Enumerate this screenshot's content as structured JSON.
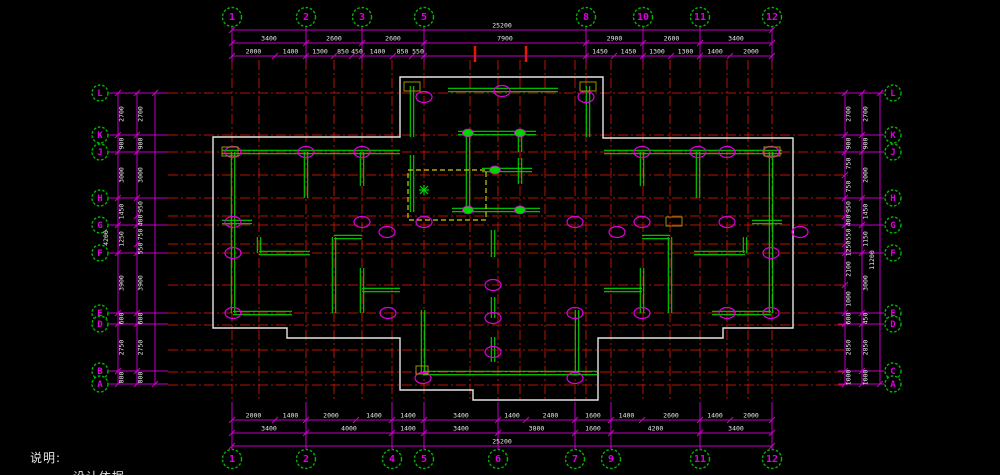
{
  "note": {
    "title": "说明:",
    "line2": "一.设计依据"
  },
  "colors": {
    "background": "#000000",
    "dim_magenta": "#c400c4",
    "bubble_ring_green": "#00b400",
    "bubble_text_magenta": "#dd00dd",
    "grid_red": "#b71400",
    "bright_red": "#e81800",
    "wall_green": "#00d400",
    "outline_white": "#e6e6e6",
    "dim_text_white": "#e8e8e8",
    "aux_yellow": "#cfcf00",
    "olive": "#9d8f00"
  },
  "axes": {
    "top": {
      "y": 17,
      "items": [
        {
          "label": "1",
          "x": 232
        },
        {
          "label": "2",
          "x": 306
        },
        {
          "label": "3",
          "x": 362
        },
        {
          "label": "5",
          "x": 424
        },
        {
          "label": "8",
          "x": 586
        },
        {
          "label": "10",
          "x": 643
        },
        {
          "label": "11",
          "x": 700
        },
        {
          "label": "12",
          "x": 772
        }
      ]
    },
    "bottom": {
      "y": 459,
      "items": [
        {
          "label": "1",
          "x": 232
        },
        {
          "label": "2",
          "x": 306
        },
        {
          "label": "4",
          "x": 392
        },
        {
          "label": "5",
          "x": 424
        },
        {
          "label": "6",
          "x": 498
        },
        {
          "label": "7",
          "x": 575
        },
        {
          "label": "9",
          "x": 611
        },
        {
          "label": "11",
          "x": 700
        },
        {
          "label": "12",
          "x": 772
        }
      ]
    },
    "left": {
      "x": 100,
      "items": [
        {
          "label": "L",
          "y": 93
        },
        {
          "label": "K",
          "y": 135
        },
        {
          "label": "J",
          "y": 152
        },
        {
          "label": "H",
          "y": 198
        },
        {
          "label": "G",
          "y": 225
        },
        {
          "label": "F",
          "y": 253
        },
        {
          "label": "E",
          "y": 313
        },
        {
          "label": "D",
          "y": 324
        },
        {
          "label": "B",
          "y": 371
        },
        {
          "label": "A",
          "y": 384
        }
      ]
    },
    "right": {
      "x": 893,
      "items": [
        {
          "label": "L",
          "y": 93
        },
        {
          "label": "K",
          "y": 135
        },
        {
          "label": "J",
          "y": 152
        },
        {
          "label": "H",
          "y": 198
        },
        {
          "label": "G",
          "y": 225
        },
        {
          "label": "F",
          "y": 253
        },
        {
          "label": "E",
          "y": 313
        },
        {
          "label": "D",
          "y": 324
        },
        {
          "label": "C",
          "y": 371
        },
        {
          "label": "A",
          "y": 384
        }
      ]
    }
  },
  "dimensions": {
    "chains": [
      {
        "name": "top-total",
        "dir": "h",
        "line": 30,
        "bounds": [
          232,
          772
        ],
        "labels": [
          "25200"
        ]
      },
      {
        "name": "top-major",
        "dir": "h",
        "line": 43,
        "bounds": [
          232,
          306,
          362,
          424,
          586,
          643,
          700,
          772
        ],
        "labels": [
          "3400",
          "2600",
          "2600",
          "7900",
          "2900",
          "2600",
          "3400"
        ]
      },
      {
        "name": "top-minor",
        "dir": "h",
        "line": 56,
        "bounds": [
          232,
          275,
          306,
          334,
          352,
          362,
          393,
          412,
          424,
          586,
          614,
          643,
          671,
          700,
          730,
          772
        ],
        "labels": [
          "2000",
          "1400",
          "1300",
          "850",
          "450",
          "1400",
          "850",
          "550",
          "",
          "1450",
          "1450",
          "1300",
          "1300",
          "1400",
          "2000"
        ]
      },
      {
        "name": "bottom-minor",
        "dir": "h",
        "line": 420,
        "bounds": [
          232,
          275,
          306,
          356,
          392,
          424,
          498,
          526,
          575,
          611,
          642,
          700,
          730,
          772
        ],
        "labels": [
          "2000",
          "1400",
          "2000",
          "1400",
          "1400",
          "3400",
          "1400",
          "2400",
          "1600",
          "1400",
          "2600",
          "1400",
          "2000"
        ]
      },
      {
        "name": "bottom-major",
        "dir": "h",
        "line": 433,
        "bounds": [
          232,
          306,
          392,
          424,
          498,
          575,
          611,
          700,
          772
        ],
        "labels": [
          "3400",
          "4000",
          "1400",
          "3400",
          "3800",
          "1600",
          "4200",
          "3400"
        ]
      },
      {
        "name": "bottom-total",
        "dir": "h",
        "line": 446,
        "bounds": [
          232,
          772
        ],
        "labels": [
          "25200"
        ]
      },
      {
        "name": "left-outer",
        "dir": "v",
        "line": 118,
        "bounds": [
          93,
          135,
          152,
          198,
          225,
          253,
          313,
          324,
          371,
          384
        ],
        "labels": [
          "2700",
          "900",
          "3000",
          "1450",
          "1250",
          "3900",
          "600",
          "2750",
          "800"
        ]
      },
      {
        "name": "left-inner",
        "dir": "v",
        "line": 137,
        "bounds": [
          93,
          135,
          152,
          198,
          216,
          225,
          244,
          253,
          313,
          324,
          371,
          384
        ],
        "labels": [
          "2700",
          "900",
          "3000",
          "950",
          "400",
          "750",
          "550",
          "3900",
          "600",
          "2750",
          "800"
        ]
      },
      {
        "name": "left-edge",
        "dir": "v",
        "line": 155,
        "bounds": [
          93,
          384
        ],
        "labels": [
          ""
        ]
      },
      {
        "name": "right-inner",
        "dir": "v",
        "line": 845,
        "bounds": [
          93,
          135,
          152,
          175,
          198,
          216,
          225,
          244,
          253,
          285,
          313,
          324,
          371,
          384
        ],
        "labels": [
          "2700",
          "900",
          "750",
          "750",
          "950",
          "400",
          "550",
          "1250",
          "2100",
          "1000",
          "600",
          "2850",
          "1000"
        ]
      },
      {
        "name": "right-outer",
        "dir": "v",
        "line": 862,
        "bounds": [
          93,
          135,
          152,
          198,
          225,
          253,
          313,
          324,
          371,
          384
        ],
        "labels": [
          "2700",
          "900",
          "2000",
          "1450",
          "1150",
          "3000",
          "450",
          "2850",
          "1000"
        ]
      },
      {
        "name": "right-edge",
        "dir": "v",
        "line": 880,
        "bounds": [
          93,
          384
        ],
        "labels": [
          ""
        ]
      }
    ],
    "extra_labels": [
      {
        "text": "4200",
        "x": 108,
        "y": 238
      },
      {
        "text": "11200",
        "x": 874,
        "y": 260
      }
    ]
  },
  "drawing": {
    "grid_top": 60,
    "grid_bottom": 402,
    "grid_left": 168,
    "grid_right": 848,
    "vgrids": [
      232,
      259,
      306,
      334,
      362,
      392,
      424,
      470,
      498,
      520,
      545,
      575,
      586,
      611,
      643,
      670,
      700,
      727,
      748,
      772
    ],
    "hgrids": [
      93,
      135,
      152,
      175,
      198,
      216,
      225,
      244,
      253,
      285,
      313,
      325,
      350,
      372,
      385
    ],
    "bright_ticks": [
      {
        "x": 475,
        "y1": 46,
        "y2": 62
      },
      {
        "x": 526,
        "y1": 46,
        "y2": 62
      }
    ],
    "outline": "213,137 400,137 400,77 603,77 603,138 793,138 793,328 723,328 723,338 598,338 598,400 473,400 473,390 400,390 400,338 287,338 287,328 213,328",
    "walls": [
      [
        222,
        152,
        400,
        152
      ],
      [
        233,
        152,
        233,
        313
      ],
      [
        306,
        152,
        306,
        198
      ],
      [
        362,
        152,
        362,
        186
      ],
      [
        222,
        222,
        252,
        222
      ],
      [
        259,
        237,
        259,
        253
      ],
      [
        259,
        253,
        310,
        253
      ],
      [
        334,
        237,
        334,
        313
      ],
      [
        334,
        237,
        362,
        237
      ],
      [
        233,
        313,
        292,
        313
      ],
      [
        362,
        268,
        362,
        313
      ],
      [
        362,
        290,
        400,
        290
      ],
      [
        412,
        86,
        412,
        137
      ],
      [
        588,
        86,
        588,
        137
      ],
      [
        448,
        90,
        558,
        90
      ],
      [
        458,
        133,
        536,
        133
      ],
      [
        468,
        133,
        468,
        212
      ],
      [
        520,
        133,
        520,
        152
      ],
      [
        482,
        170,
        532,
        170
      ],
      [
        520,
        158,
        520,
        184
      ],
      [
        452,
        210,
        540,
        210
      ],
      [
        412,
        155,
        412,
        212
      ],
      [
        423,
        310,
        423,
        373
      ],
      [
        423,
        373,
        597,
        373
      ],
      [
        577,
        310,
        577,
        373
      ],
      [
        493,
        230,
        493,
        257
      ],
      [
        493,
        297,
        493,
        318
      ],
      [
        493,
        337,
        493,
        362
      ],
      [
        604,
        152,
        782,
        152
      ],
      [
        771,
        152,
        771,
        313
      ],
      [
        698,
        152,
        698,
        198
      ],
      [
        642,
        152,
        642,
        186
      ],
      [
        752,
        222,
        782,
        222
      ],
      [
        745,
        237,
        745,
        253
      ],
      [
        694,
        253,
        745,
        253
      ],
      [
        670,
        237,
        670,
        313
      ],
      [
        642,
        237,
        670,
        237
      ],
      [
        712,
        313,
        771,
        313
      ],
      [
        642,
        268,
        642,
        313
      ],
      [
        604,
        290,
        642,
        290
      ]
    ],
    "columns": [
      [
        233,
        152
      ],
      [
        306,
        152
      ],
      [
        362,
        152
      ],
      [
        424,
        97
      ],
      [
        502,
        91
      ],
      [
        586,
        97
      ],
      [
        642,
        152
      ],
      [
        698,
        152
      ],
      [
        727,
        152
      ],
      [
        771,
        152
      ],
      [
        233,
        222
      ],
      [
        362,
        222
      ],
      [
        424,
        222
      ],
      [
        575,
        222
      ],
      [
        642,
        222
      ],
      [
        727,
        222
      ],
      [
        800,
        232
      ],
      [
        233,
        253
      ],
      [
        771,
        253
      ],
      [
        387,
        232
      ],
      [
        617,
        232
      ],
      [
        233,
        313
      ],
      [
        388,
        313
      ],
      [
        493,
        285
      ],
      [
        493,
        318
      ],
      [
        493,
        352
      ],
      [
        575,
        313
      ],
      [
        642,
        313
      ],
      [
        727,
        313
      ],
      [
        771,
        313
      ],
      [
        423,
        378
      ],
      [
        575,
        378
      ]
    ],
    "dots": [
      [
        468,
        133
      ],
      [
        520,
        133
      ],
      [
        495,
        170
      ],
      [
        468,
        210
      ],
      [
        520,
        210
      ]
    ],
    "flower": [
      424,
      190
    ],
    "yellow_rect": [
      408,
      170,
      78,
      50
    ],
    "olive_rects": [
      [
        404,
        82,
        16,
        9
      ],
      [
        580,
        82,
        16,
        9
      ],
      [
        222,
        147,
        16,
        9
      ],
      [
        764,
        147,
        16,
        9
      ],
      [
        666,
        217,
        16,
        9
      ],
      [
        416,
        366,
        12,
        8
      ]
    ]
  }
}
